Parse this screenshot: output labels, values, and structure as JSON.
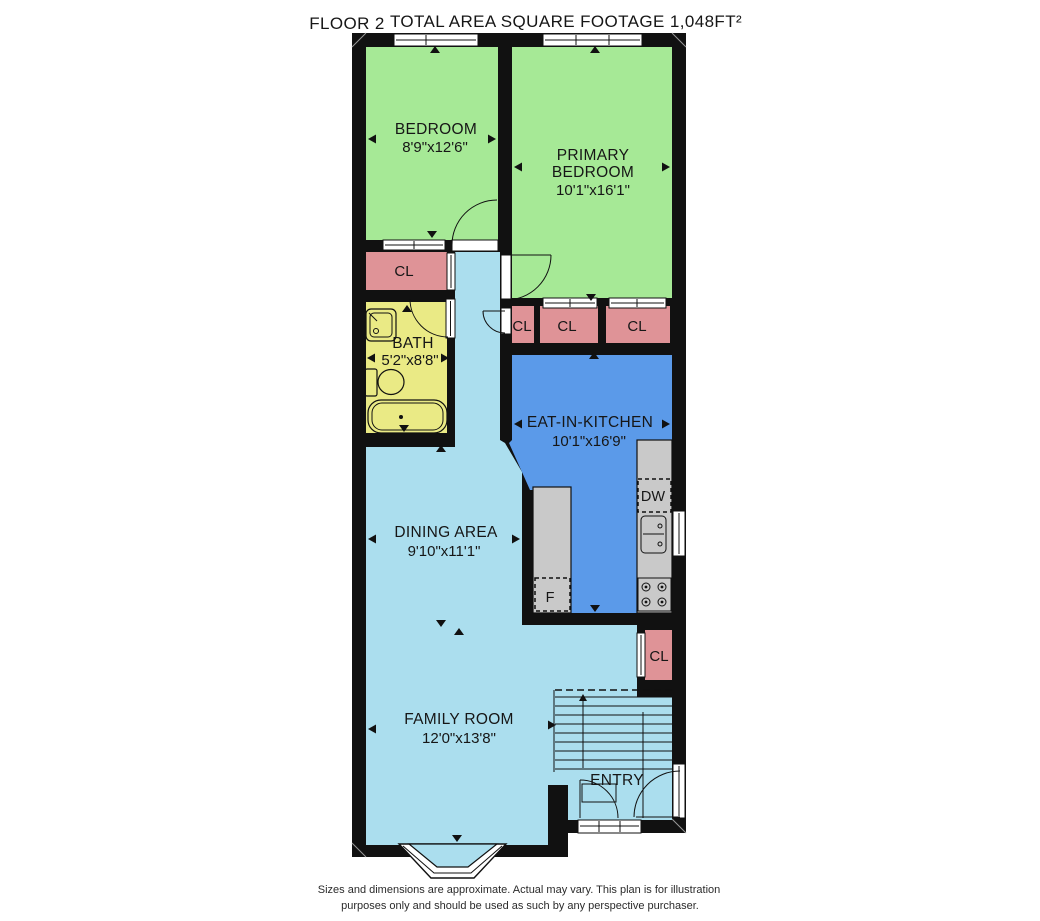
{
  "header": {
    "floor_label": "FLOOR 2",
    "title": "TOTAL AREA SQUARE FOOTAGE 1,048FT²"
  },
  "rooms": {
    "bedroom": {
      "name": "BEDROOM",
      "dims": "8'9\"x12'6\""
    },
    "primary_bedroom": {
      "name_line1": "PRIMARY",
      "name_line2": "BEDROOM",
      "dims": "10'1\"x16'1\""
    },
    "bath": {
      "name": "BATH",
      "dims": "5'2\"x8'8\""
    },
    "eat_in_kitchen": {
      "name": "EAT-IN-KITCHEN",
      "dims": "10'1\"x16'9\""
    },
    "dining_area": {
      "name": "DINING AREA",
      "dims": "9'10\"x11'1\""
    },
    "family_room": {
      "name": "FAMILY ROOM",
      "dims": "12'0\"x13'8\""
    },
    "entry": {
      "name": "ENTRY"
    }
  },
  "closets": {
    "bedroom_hall": "CL",
    "hall_small": "CL",
    "primary_a": "CL",
    "primary_b": "CL",
    "entry": "CL"
  },
  "kitchen_fixtures": {
    "dishwasher": "DW",
    "refrigerator": "F"
  },
  "footer": {
    "line1": "Sizes and dimensions are approximate. Actual may vary. This plan is for illustration",
    "line2": "purposes only and should be used as such by any perspective purchaser."
  },
  "colors": {
    "bedroom_green": "#a6e996",
    "kitchen_blue": "#5b9ae9",
    "floor_cyan": "#abdeee",
    "closet_pink": "#df9397",
    "bath_yellow": "#eaea85",
    "counter_gray": "#c9c9c9",
    "wall": "#111111"
  }
}
